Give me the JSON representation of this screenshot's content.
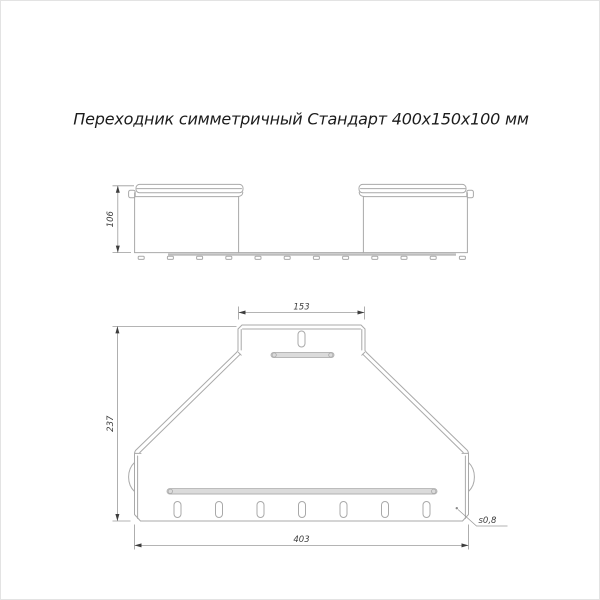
{
  "title": "Переходник симметричный Стандарт 400х150х100 мм",
  "side_view": {
    "height_dim": "106"
  },
  "plan_view": {
    "top_width_dim": "153",
    "height_dim": "237",
    "bottom_width_dim": "403",
    "thickness_note": "s0,8"
  },
  "colors": {
    "outline": "#a9a9a9",
    "dimension_line": "#9b9b9b",
    "dimension_text": "#3d3d3d",
    "title_text": "#1c1c1c",
    "rib_fill": "#dbdbdb",
    "rib_stroke": "#b2b2b2",
    "base_thick_edge": "#bdbdbd",
    "page_border": "#e3e3e3",
    "background": "#ffffff"
  }
}
